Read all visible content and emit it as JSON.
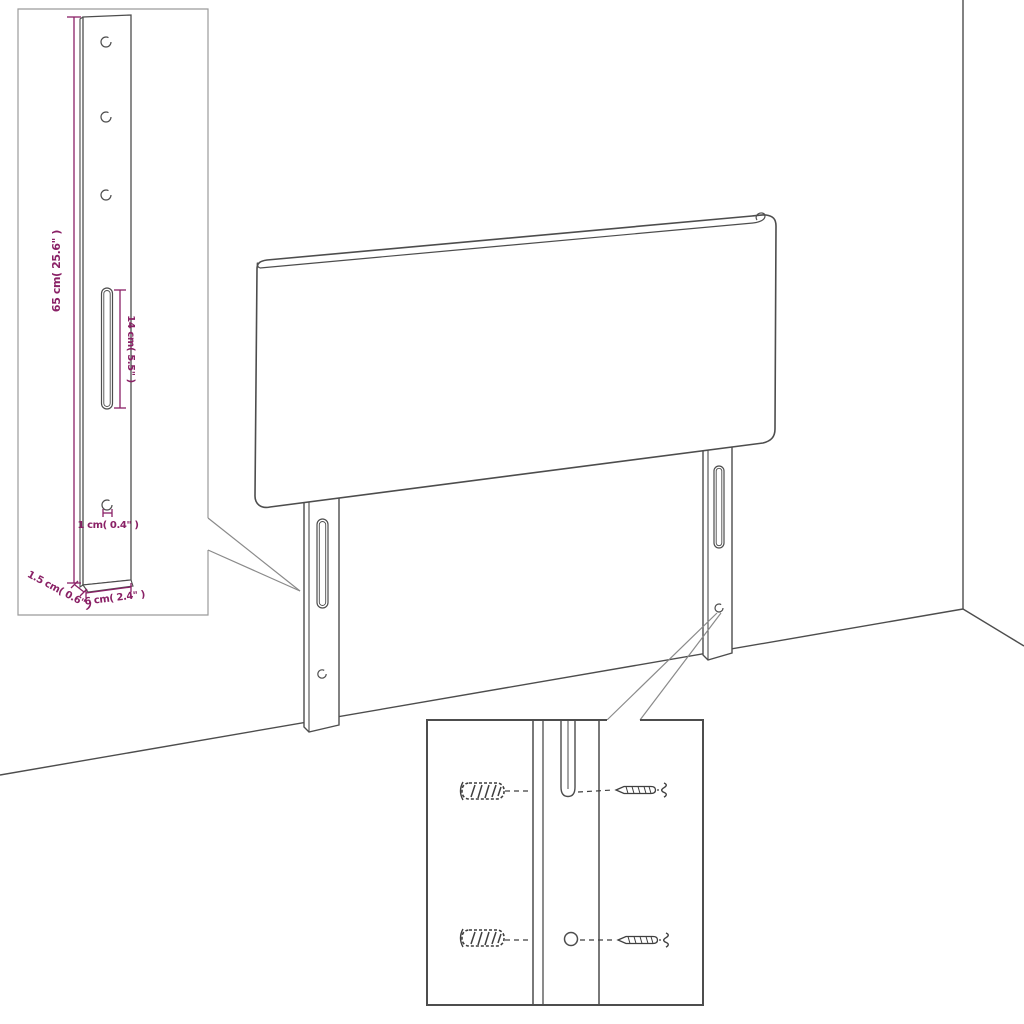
{
  "diagram": {
    "kind": "headboard-assembly-dimension-diagram",
    "colors": {
      "dimension_accent": "#8A2166",
      "line_art": "#4D4D4D",
      "inset_border_light": "#9B9B9B"
    },
    "dimension_labels": {
      "bracket_height": "65 cm( 25.6\" )",
      "slot_length": "14 cm( 5.5\" )",
      "hole_size": "1 cm( 0.4\" )",
      "bracket_depth": "1.5 cm( 0.6\" )",
      "bracket_width": "6 cm( 2.4\" )"
    }
  }
}
